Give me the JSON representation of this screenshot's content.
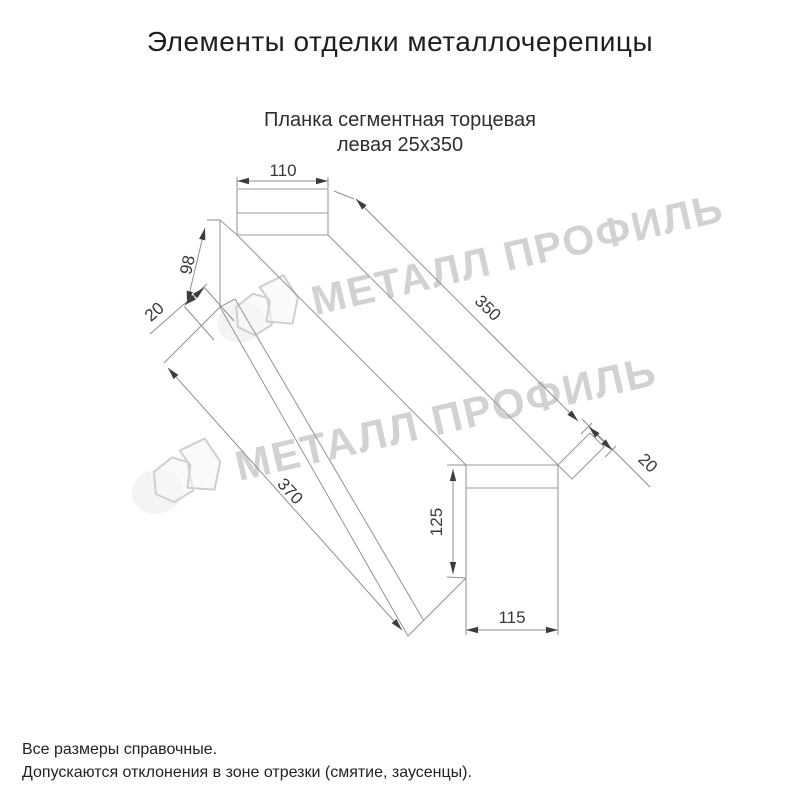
{
  "title": "Элементы отделки металлочерепицы",
  "subtitle": {
    "line1": "Планка сегментная торцевая",
    "line2": "левая 25х350"
  },
  "product": "Планка сегментная торцевая левая 25х350",
  "watermark": {
    "text": "МЕТАЛЛ ПРОФИЛЬ"
  },
  "dimensions": {
    "top_width": "110",
    "left_height": "98",
    "left_fold": "20",
    "length_top": "350",
    "length_bottom": "370",
    "right_fold": "20",
    "side_height": "125",
    "side_width": "115"
  },
  "footer": {
    "line1": "Все размеры справочные.",
    "line2": "Допускаются отклонения в зоне отрезки (смятие, заусенцы)."
  },
  "colors": {
    "background": "#ffffff",
    "drawing_line": "#9b9b9b",
    "dimension_text": "#383838",
    "title_text": "#1e1e1e",
    "watermark": "#d2d2d2"
  }
}
